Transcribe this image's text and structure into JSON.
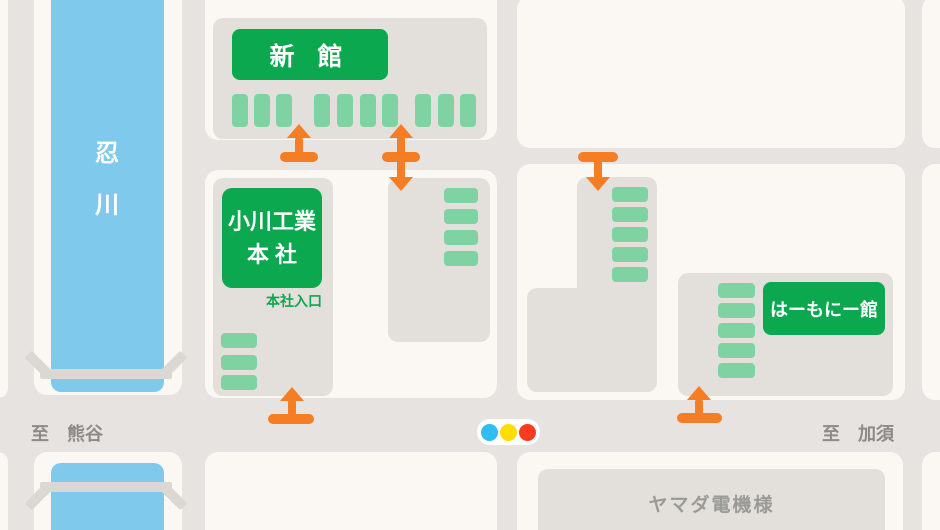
{
  "map_title": "access-map",
  "river": {
    "name": "忍川",
    "char1": "忍",
    "char2": "川",
    "color": "#7fc9ec"
  },
  "buildings": {
    "shinkan": {
      "label": "新 館"
    },
    "honsha": {
      "label_line1": "小川工業",
      "label_line2": "本 社",
      "entrance_note": "本社入口"
    },
    "harmony": {
      "label": "はーもにー館"
    },
    "yamada": {
      "label": "ヤマダ電機様"
    }
  },
  "roads": {
    "west_label": "至　熊谷",
    "east_label": "至　加須"
  },
  "traffic_light": {
    "colors": [
      "#2fbdf2",
      "#ffdd00",
      "#fa3b1d"
    ]
  },
  "palette": {
    "building_label_green": "#0ba84f",
    "parking_stripe_green": "#7fd3a2",
    "entrance_arrow_orange": "#f57d23",
    "river_blue": "#7fc9ec",
    "block_cream": "#fbf7f2",
    "road_gray": "#e6e3e0",
    "lot_gray": "#e3e0dc",
    "road_text_gray": "#8b8b87"
  }
}
